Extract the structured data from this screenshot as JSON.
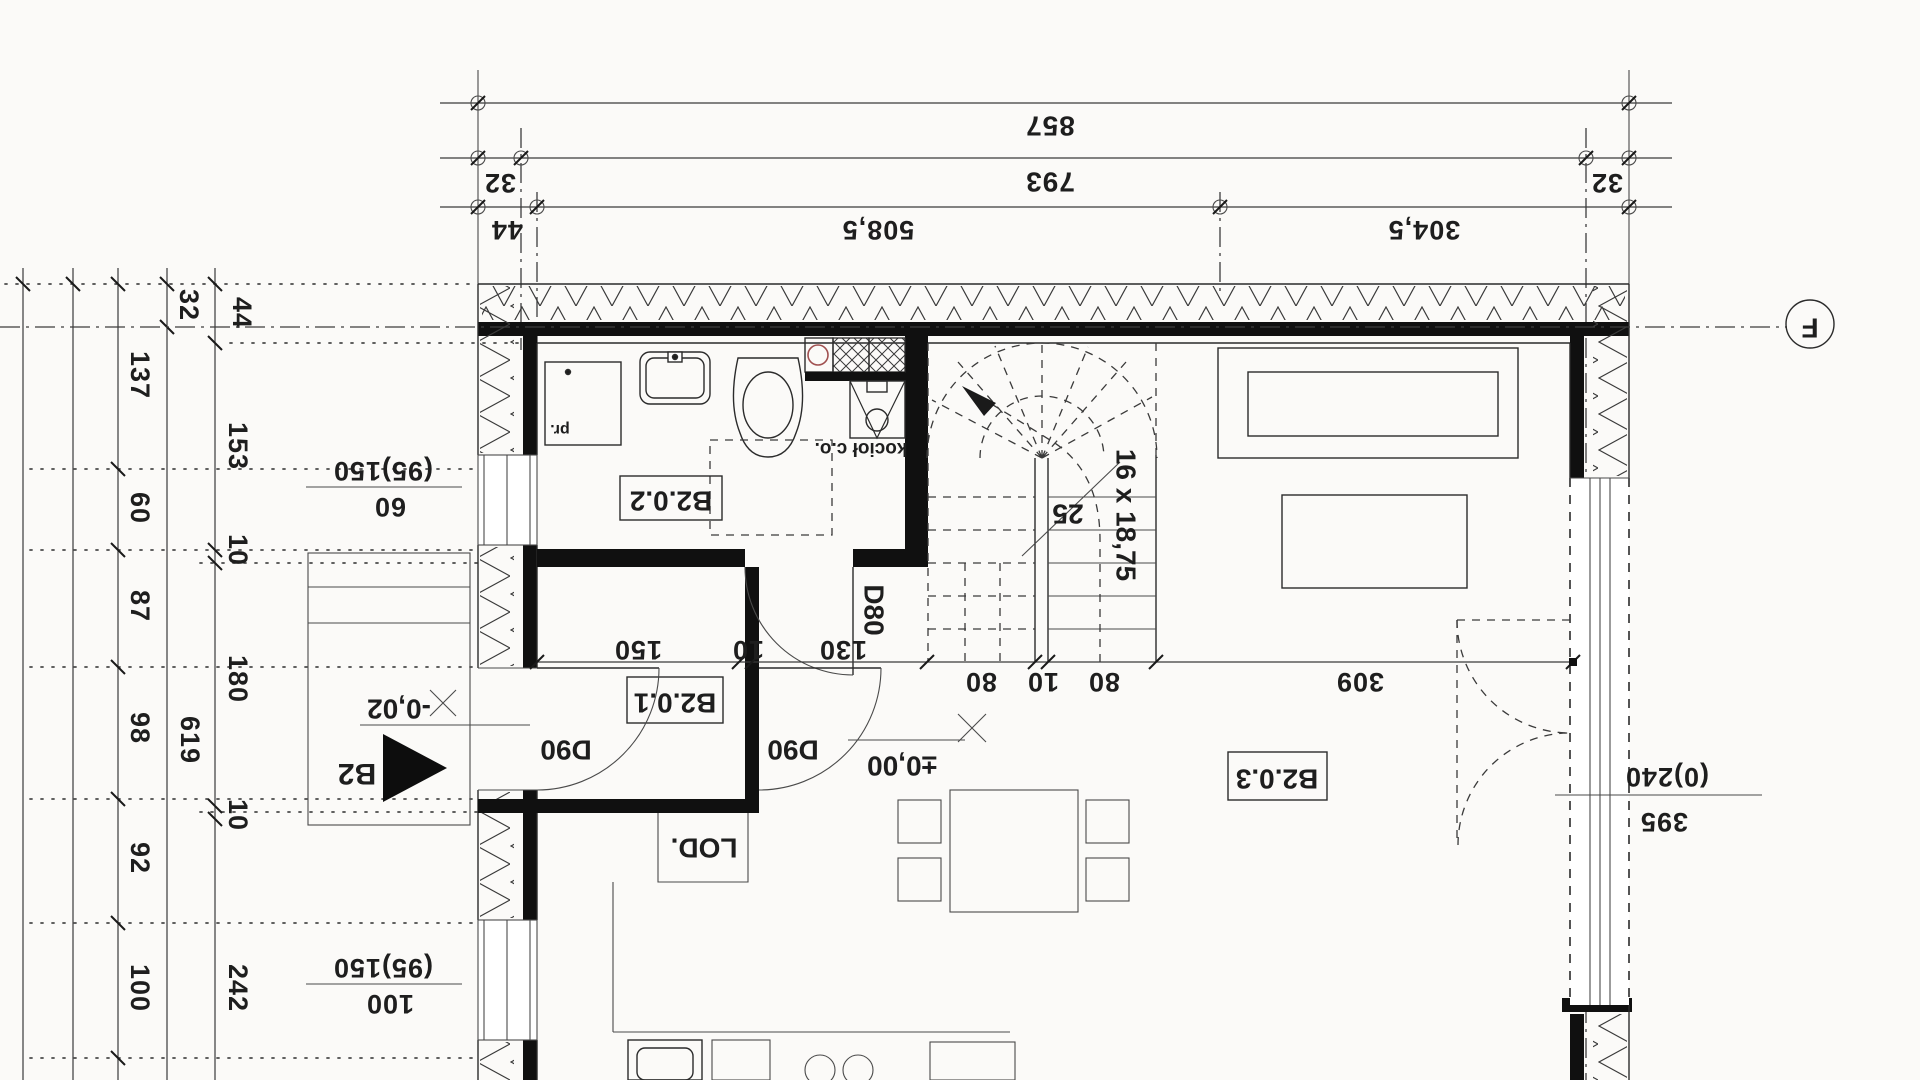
{
  "drawing": {
    "axis_marker": "F",
    "section_marker": "B2",
    "dims_top": {
      "overall": "857",
      "axis_span": "793",
      "offset_left": "32",
      "offset_right": "32",
      "wall": "44",
      "seg1": "508,5",
      "seg2": "304,5"
    },
    "dims_left": [
      "32",
      "44",
      "137",
      "153",
      "60",
      "10",
      "87",
      "180",
      "98",
      "619",
      "10",
      "92",
      "100",
      "242"
    ],
    "dims_interior": [
      "150",
      "10",
      "130",
      "80",
      "10",
      "80",
      "309"
    ],
    "rooms": {
      "bathroom": "B2.0.2",
      "hall": "B2.0.1",
      "living": "B2.0.3"
    },
    "doors": {
      "d80": "D80",
      "d90_left": "D90",
      "d90_right": "D90"
    },
    "stairs": {
      "formula": "16 x 18,75",
      "count": "25"
    },
    "levels": {
      "floor": "±0,00",
      "entry": "-0,02"
    },
    "equipment": {
      "fridge": "LOD.",
      "boiler": "kocioł c.o.",
      "washer": "pr."
    },
    "window_specs": {
      "left_upper_size": "(95)150",
      "left_upper_sill": "60",
      "left_lower_size": "(95)150",
      "left_lower_sill": "100",
      "right_size": "(0)240",
      "right_width": "395"
    },
    "colors": {
      "line": "#1e1e1e",
      "shaft_circle": "#a05050"
    }
  }
}
